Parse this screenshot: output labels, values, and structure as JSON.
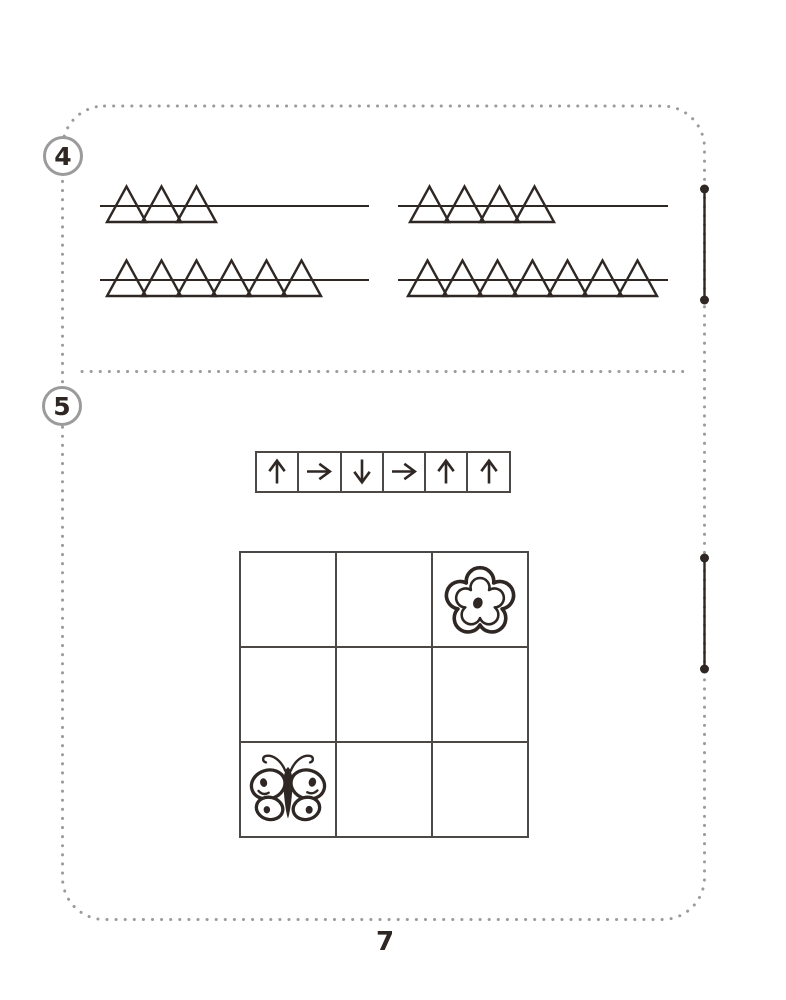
{
  "page": {
    "number": "7",
    "background": "#ffffff"
  },
  "colors": {
    "ink": "#2e2723",
    "frame_gray": "#9b9b9b",
    "grid_line": "#4c4846"
  },
  "exercise4": {
    "number": "4",
    "groups": [
      {
        "row": 1,
        "side": "left",
        "triangles": 3
      },
      {
        "row": 1,
        "side": "right",
        "triangles": 4
      },
      {
        "row": 2,
        "side": "left",
        "triangles": 6
      },
      {
        "row": 2,
        "side": "right",
        "triangles": 7
      }
    ]
  },
  "exercise5": {
    "number": "5",
    "arrows": [
      "up",
      "right",
      "down",
      "right",
      "up",
      "up"
    ],
    "grid": {
      "rows": 3,
      "cols": 3,
      "cells": [
        [
          "",
          "",
          "flower"
        ],
        [
          "",
          "",
          ""
        ],
        [
          "butterfly",
          "",
          ""
        ]
      ]
    }
  }
}
